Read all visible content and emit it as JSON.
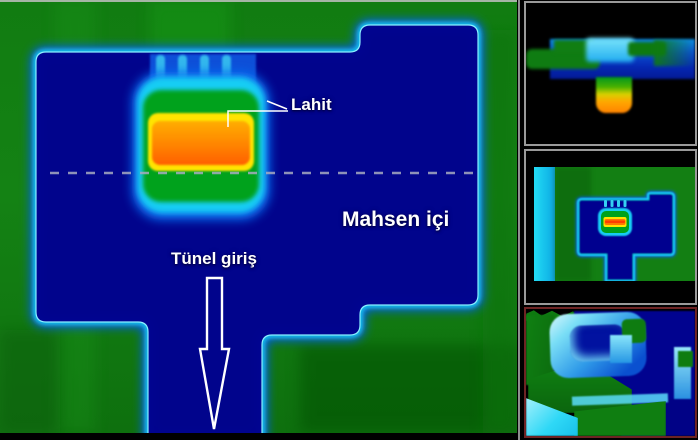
{
  "figure": {
    "annotations": {
      "lahit": "Lahit",
      "mahsen": "Mahsen içi",
      "tunel": "Tünel giriş"
    },
    "colors": {
      "soil_green": "#117c11",
      "void_navy": "#01028f",
      "edge_cyan": "#19cdf4",
      "target_orange": "#ff8c00",
      "target_yellow": "#ffe400",
      "target_green": "#00a21c",
      "dashed_line_gray": "#a7abc0",
      "label_white": "#ffffff",
      "panel_border_gray": "#9a9a9a",
      "panel3_border_maroon": "#6e2424",
      "frame_black": "#000000"
    }
  }
}
